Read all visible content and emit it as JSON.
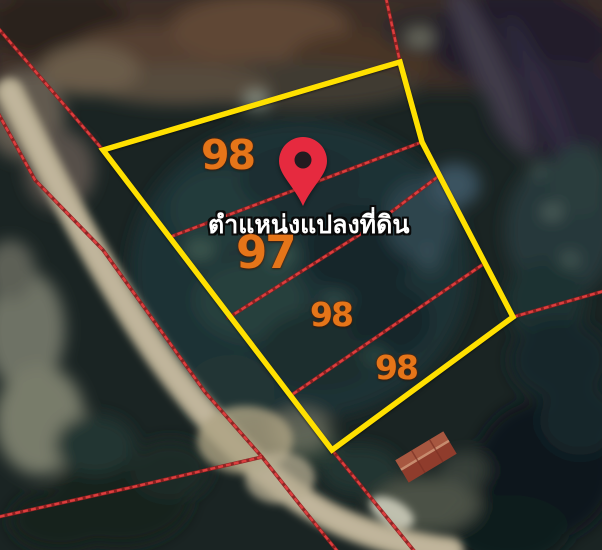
{
  "map": {
    "view_type": "satellite-cadastral-overlay",
    "marker_label": "ตำแหน่งแปลงที่ดิน",
    "parcel_labels": [
      {
        "id": "parcel-98-top",
        "text": "98"
      },
      {
        "id": "parcel-97",
        "text": "97"
      },
      {
        "id": "parcel-98-middle",
        "text": "98"
      },
      {
        "id": "parcel-98-bottom",
        "text": "98"
      }
    ],
    "icons": [
      {
        "name": "location-pin-icon",
        "meaning": "marked land plot position"
      }
    ],
    "colors": {
      "plot_boundary": "#ffe000",
      "cadastral_line": "#e04040",
      "marker": "#e62a3f",
      "parcel_number": "#e57519",
      "marker_label_text": "#ffffff",
      "road": "#b2a88d"
    }
  }
}
